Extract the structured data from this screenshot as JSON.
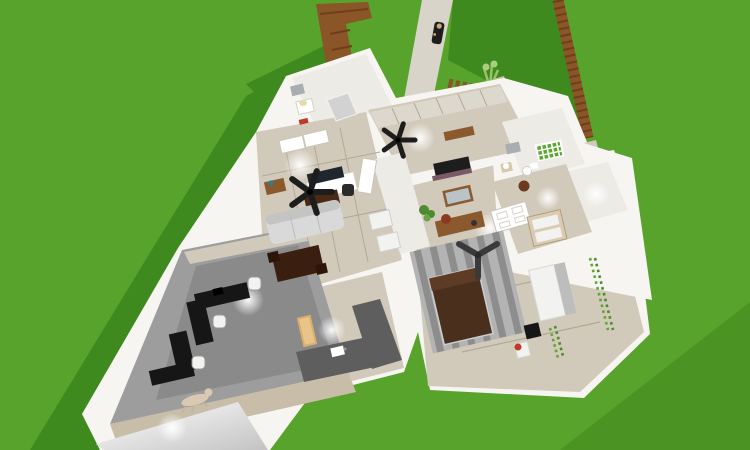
{
  "app": {
    "view_label": "3D floor plan render, top-down perspective view"
  },
  "colors": {
    "grass": "#57a32b",
    "grass-shadow": "#3f8a1e",
    "grass-shadow2": "#4b9424",
    "path": "#d8d4ca",
    "porch": "#e4e0d8",
    "wall": "#f7f5f1",
    "wood": "#d1c9ba",
    "wood2": "#c7bda9",
    "white": "#ffffff",
    "offwhite": "#ecebe6",
    "gray-floor": "#9d9d9d",
    "rug": "#8a8a8a",
    "fence": "#8a5527",
    "fence-dark": "#6e3f1a",
    "deck": "#cfc2a8",
    "sofa": "#d9d9d9",
    "sofa-back": "#c4c4c4",
    "bed-brown": "#4b2f1d",
    "bed-pillow": "#5d3b24",
    "desk-black": "#161616",
    "counter": "#5e5e5e",
    "cabinet-wood": "#8a5a2e",
    "plant": "#4e8a2e",
    "tile-green": "#5ea832",
    "accent-red": "#bf3a2a",
    "dark": "#1d1d1d",
    "bench-tan": "#dcae6b",
    "appliance": "#f2f2f0",
    "mirror": "#a8aeb2",
    "seam": "#b3a996",
    "skin": "#caa87a",
    "tv": "#20262e"
  },
  "scene": {
    "environment": [
      "lawn",
      "cast-shadows",
      "stone-walkway",
      "front-porch",
      "person-on-path",
      "wooden-fence-left",
      "wooden-fence-right",
      "deck-with-railing",
      "planter-tall-plant",
      "potted-bushes"
    ],
    "rooms": [
      {
        "name": "bathroom-small",
        "items": [
          "vanity-sink",
          "wall-mirror",
          "shower",
          "red-mat"
        ]
      },
      {
        "name": "kitchen",
        "items": [
          "upper-cabinets",
          "stove",
          "counter-front",
          "wood-console",
          "ceiling-fan-5-blade"
        ]
      },
      {
        "name": "living-dining-room",
        "items": [
          "sofa",
          "tv-on-desk",
          "desk-chair",
          "tv-console",
          "dresser-with-vase",
          "ceiling-fan-5-blade",
          "double-doors",
          "side-door",
          "dining-table-with-chairs"
        ]
      },
      {
        "name": "closet-column",
        "items": [
          "storage-boxes"
        ]
      },
      {
        "name": "bathroom-green-tile",
        "items": [
          "green-tile-wall",
          "wall-mirror",
          "sink",
          "toilet",
          "round-stool"
        ]
      },
      {
        "name": "closet-empty",
        "items": []
      },
      {
        "name": "kids-room",
        "items": [
          "bunk-bed",
          "panel-door-open"
        ]
      },
      {
        "name": "master-bedroom",
        "items": [
          "wall-mirror-framed",
          "dresser",
          "bowl",
          "potted-plant",
          "ceiling-fan-3-blade",
          "striped-rug",
          "bed-dark-brown",
          "white-wardrobe",
          "black-printer-box",
          "chair-with-red-cup",
          "ivy-wall-decor"
        ]
      },
      {
        "name": "kitchenette",
        "items": [
          "l-shaped-counter",
          "sink",
          "tan-bench"
        ]
      },
      {
        "name": "office",
        "items": [
          "gray-rug",
          "black-desk-upper",
          "black-desk-lower",
          "office-chair-1",
          "office-chair-2",
          "monitor"
        ]
      },
      {
        "name": "hallway",
        "items": [
          "dog-lying"
        ]
      },
      {
        "name": "garage-room",
        "items": []
      }
    ]
  }
}
